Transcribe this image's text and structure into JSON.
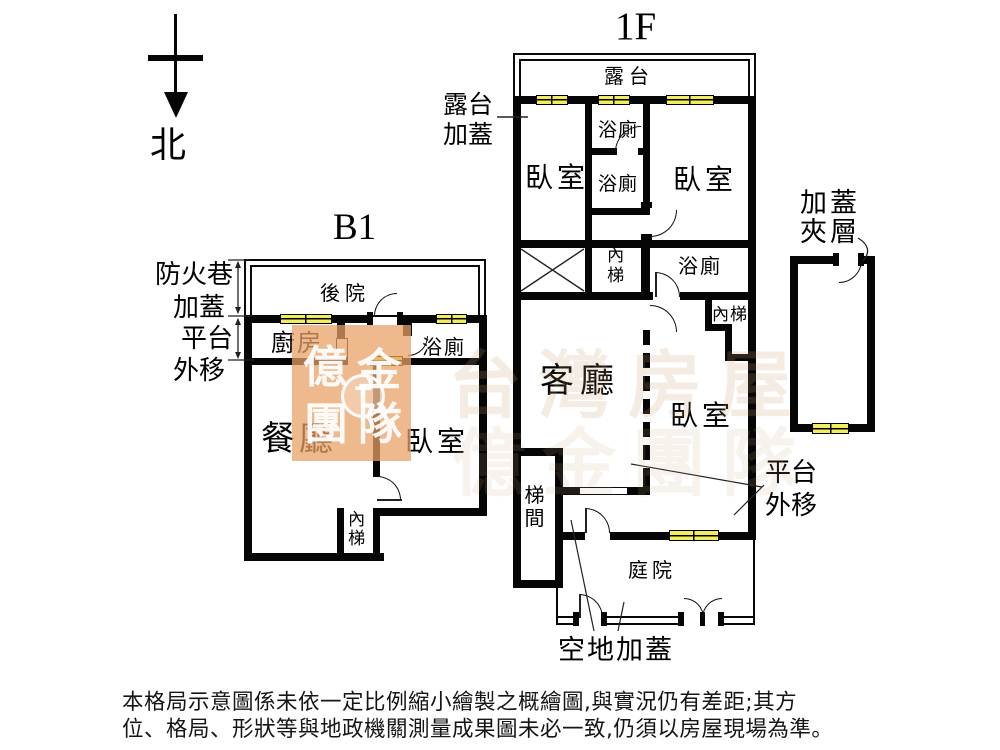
{
  "north": {
    "label": "北"
  },
  "b1": {
    "title": "B1",
    "outside_labels": [
      "防火巷",
      "加蓋",
      "平台",
      "外移"
    ],
    "rooms": {
      "backyard": "後院",
      "kitchen": "廚房",
      "bath": "浴廁",
      "dining": "餐廳",
      "bedroom": "臥室",
      "stairs": "內梯"
    }
  },
  "f1": {
    "title": "1F",
    "rooms": {
      "terrace": "露台",
      "bedroom_left": "臥室",
      "bath_top": "浴廁",
      "bath_mid": "浴廁",
      "bedroom_right": "臥室",
      "stairs_upper": "內梯",
      "bath_inner": "浴廁",
      "stairs_lower": "內梯",
      "living": "客廳",
      "bedroom_lower": "臥室",
      "stairwell": "梯間",
      "courtyard": "庭院"
    },
    "annotations": {
      "terrace_cover_l1": "露台",
      "terrace_cover_l2": "加蓋",
      "platform_l1": "平台",
      "platform_l2": "外移",
      "ground_cover": "空地加蓋"
    }
  },
  "mezzanine": {
    "label_l1": "加蓋",
    "label_l2": "夾層"
  },
  "watermark": {
    "chars": [
      "億",
      "金",
      "團",
      "隊"
    ],
    "logo_letter": "T",
    "faint_row_1": "台灣房屋",
    "faint_row_2": "億金團隊"
  },
  "colors": {
    "wall": "#060606",
    "window": "#f2ec5f",
    "watermark_block": "#e9a066"
  },
  "disclaimer": {
    "line1": "本格局示意圖係未依一定比例縮小繪製之概繪圖,與實況仍有差距;其方",
    "line2": "位、格局、形狀等與地政機關測量成果圖未必一致,仍須以房屋現場為準。"
  }
}
